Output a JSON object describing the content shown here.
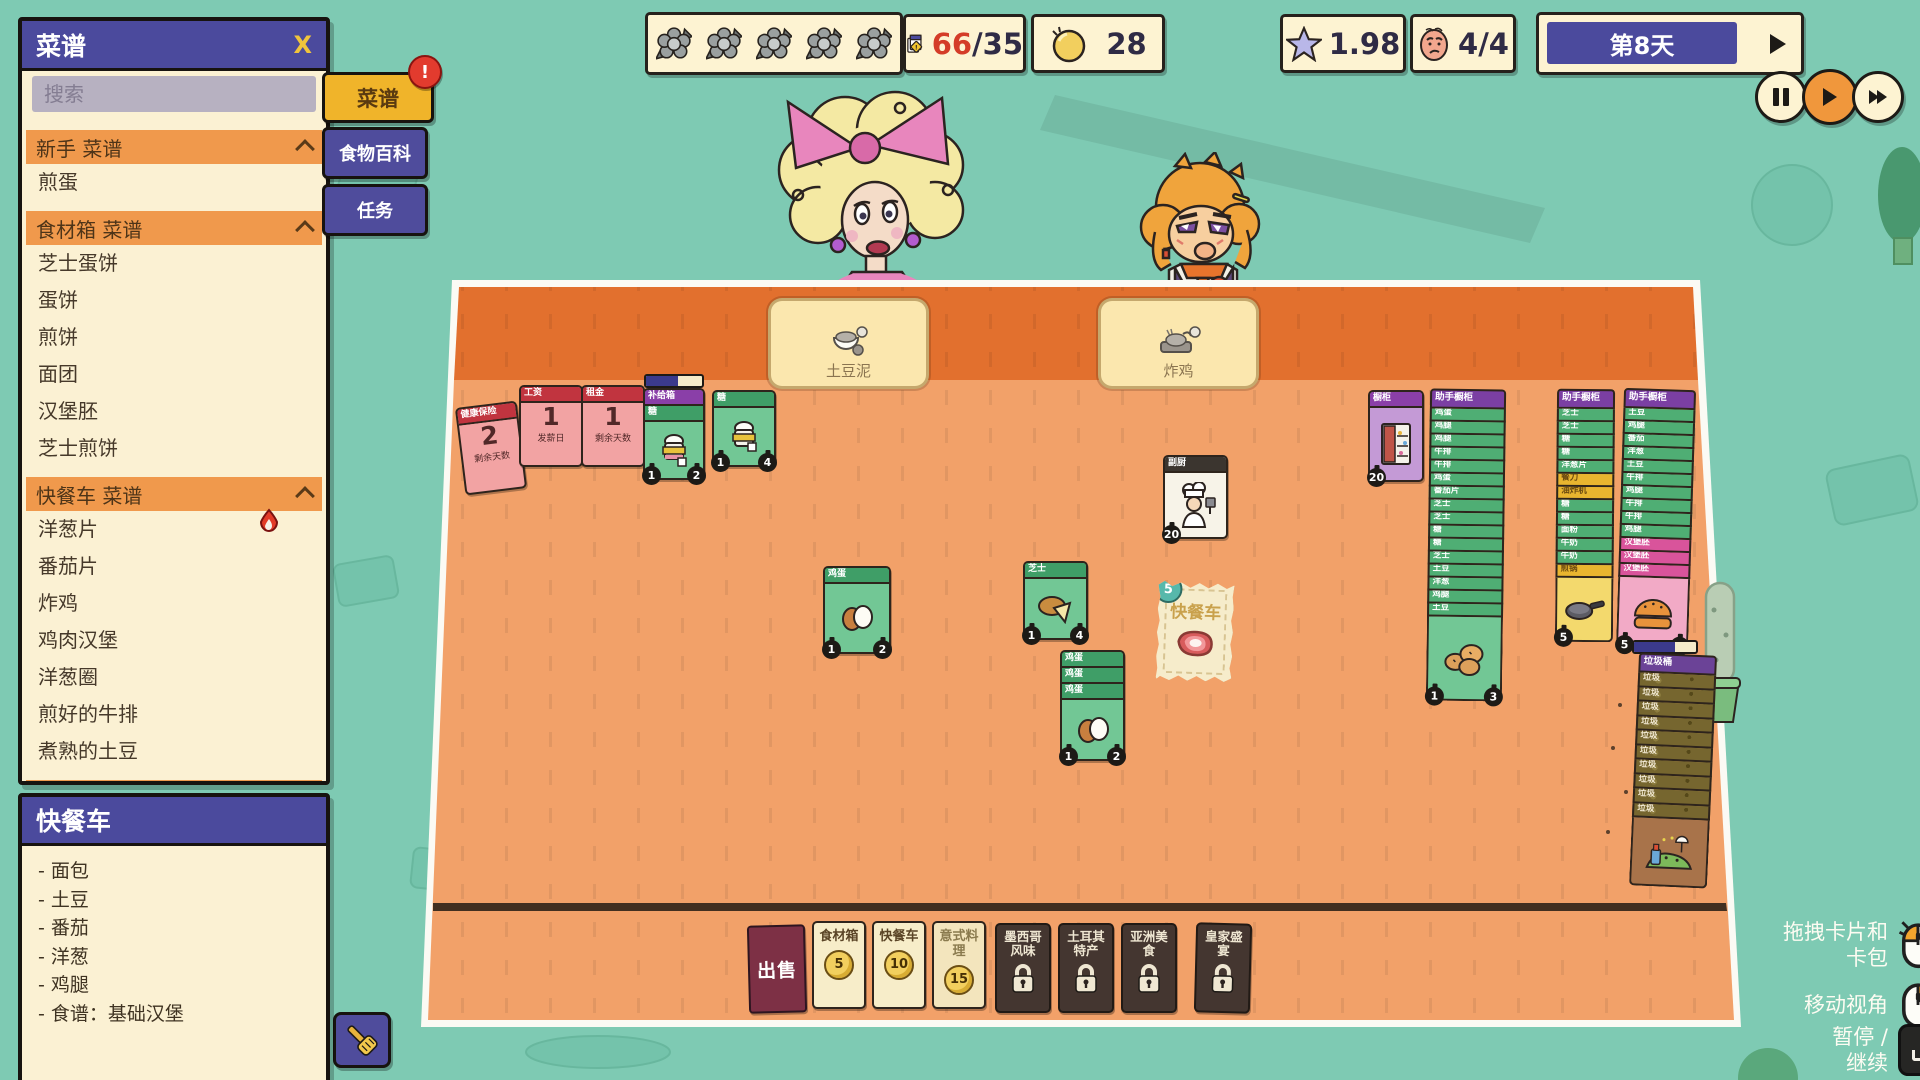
{
  "colors": {
    "background_teal": "#7ecab3",
    "board_top_orange": "#e2702e",
    "board_main_orange": "#f2a169",
    "panel_purple": "#4b4a9d",
    "section_orange": "#f0994c",
    "button_gold": "#f0b42a",
    "card_green": "#4fae74",
    "card_pink": "#f2a3a3",
    "locked_brown": "#443630",
    "sell_maroon": "#7d3045",
    "coin_yellow": "#f2cf5e",
    "alert_red": "#e23b2e"
  },
  "topbar": {
    "flowers": [
      "",
      "",
      "",
      "",
      ""
    ],
    "orders_current": "66",
    "orders_max": "/35",
    "coins": "28",
    "stars": "1.98",
    "mood": "4/4",
    "day_label": "第8天"
  },
  "side_buttons": {
    "recipes": "菜谱",
    "recipes_badge": "!",
    "encyclopedia": "食物百科",
    "tasks": "任务"
  },
  "recipes_panel": {
    "title": "菜谱",
    "close_label": "X",
    "search_placeholder": "搜索",
    "list": [
      {
        "kind": "header",
        "label": "新手 菜谱"
      },
      {
        "kind": "item",
        "label": "煎蛋"
      },
      {
        "kind": "header",
        "label": "食材箱 菜谱"
      },
      {
        "kind": "item",
        "label": "芝士蛋饼"
      },
      {
        "kind": "item",
        "label": "蛋饼"
      },
      {
        "kind": "item",
        "label": "煎饼"
      },
      {
        "kind": "item",
        "label": "面团"
      },
      {
        "kind": "item",
        "label": "汉堡胚"
      },
      {
        "kind": "item",
        "label": "芝士煎饼"
      },
      {
        "kind": "header",
        "label": "快餐车 菜谱"
      },
      {
        "kind": "item",
        "label": "洋葱片"
      },
      {
        "kind": "item",
        "label": "番茄片"
      },
      {
        "kind": "item",
        "label": "炸鸡"
      },
      {
        "kind": "item",
        "label": "鸡肉汉堡"
      },
      {
        "kind": "item",
        "label": "洋葱圈"
      },
      {
        "kind": "item",
        "label": "煎好的牛排"
      },
      {
        "kind": "item",
        "label": "煮熟的土豆"
      },
      {
        "kind": "header",
        "label": "意式料理 菜谱"
      }
    ]
  },
  "foodtruck_panel": {
    "title": "快餐车",
    "items": [
      "- 面包",
      "- 土豆",
      "- 番茄",
      "- 洋葱",
      "- 鸡腿",
      "- 食谱：基础汉堡"
    ]
  },
  "board": {
    "order_slots": [
      {
        "label": "土豆泥"
      },
      {
        "label": "炸鸡"
      }
    ],
    "cards": {
      "insurance": {
        "title": "健康保险",
        "value": "2",
        "caption": "剩余天数"
      },
      "wage": {
        "title": "工资",
        "value": "1",
        "caption": "发薪日"
      },
      "rent": {
        "title": "租金",
        "value": "1",
        "caption": "剩余天数"
      },
      "supply_box": {
        "title": "补给箱",
        "sub": "糖",
        "badge_left": "1",
        "badge_right": "2"
      },
      "sugar": {
        "title": "糖",
        "badge_left": "1",
        "badge_right": "4"
      },
      "eggs": {
        "title": "鸡蛋",
        "badge_left": "1",
        "badge_right": "2"
      },
      "cheese": {
        "title": "芝士",
        "badge_left": "1",
        "badge_right": "4"
      },
      "egg_stack": {
        "titles": [
          "鸡蛋",
          "鸡蛋",
          "鸡蛋"
        ],
        "badge_left": "1",
        "badge_right": "2"
      },
      "sous_chef": {
        "title": "副厨",
        "badge": "20"
      },
      "cabinet": {
        "title": "橱柜",
        "badge": "20"
      },
      "truck_pack": {
        "title": "快餐车",
        "badge": "5"
      }
    },
    "stacks": {
      "helper1": {
        "title": "助手橱柜",
        "rows": [
          {
            "label": "鸡蛋",
            "type": "g"
          },
          {
            "label": "鸡腿",
            "type": "g"
          },
          {
            "label": "鸡腿",
            "type": "g"
          },
          {
            "label": "牛排",
            "type": "g"
          },
          {
            "label": "牛排",
            "type": "g"
          },
          {
            "label": "鸡蛋",
            "type": "g"
          },
          {
            "label": "番茄片",
            "type": "g"
          },
          {
            "label": "芝士",
            "type": "g"
          },
          {
            "label": "芝士",
            "type": "g"
          },
          {
            "label": "糖",
            "type": "g"
          },
          {
            "label": "糖",
            "type": "g"
          },
          {
            "label": "芝士",
            "type": "g"
          },
          {
            "label": "土豆",
            "type": "g"
          },
          {
            "label": "洋葱",
            "type": "g"
          },
          {
            "label": "鸡腿",
            "type": "g"
          },
          {
            "label": "土豆",
            "type": "g"
          }
        ],
        "badge_left": "1",
        "badge_right": "3"
      },
      "helper2": {
        "title": "助手橱柜",
        "rows": [
          {
            "label": "芝士",
            "type": "g"
          },
          {
            "label": "芝士",
            "type": "g"
          },
          {
            "label": "糖",
            "type": "g"
          },
          {
            "label": "糖",
            "type": "g"
          },
          {
            "label": "洋葱片",
            "type": "g"
          },
          {
            "label": "餐刀",
            "type": "y"
          },
          {
            "label": "油炸机",
            "type": "y"
          },
          {
            "label": "糖",
            "type": "g"
          },
          {
            "label": "糖",
            "type": "g"
          },
          {
            "label": "面粉",
            "type": "g"
          },
          {
            "label": "牛奶",
            "type": "g"
          },
          {
            "label": "牛奶",
            "type": "g"
          },
          {
            "label": "煎锅",
            "type": "y"
          }
        ],
        "badge_left": "5"
      },
      "helper3": {
        "title": "助手橱柜",
        "rows": [
          {
            "label": "土豆",
            "type": "g"
          },
          {
            "label": "鸡腿",
            "type": "g"
          },
          {
            "label": "番茄",
            "type": "g"
          },
          {
            "label": "洋葱",
            "type": "g"
          },
          {
            "label": "土豆",
            "type": "g"
          },
          {
            "label": "牛排",
            "type": "g"
          },
          {
            "label": "鸡腿",
            "type": "g"
          },
          {
            "label": "牛排",
            "type": "g"
          },
          {
            "label": "牛排",
            "type": "g"
          },
          {
            "label": "鸡腿",
            "type": "g"
          },
          {
            "label": "汉堡胚",
            "type": "p"
          },
          {
            "label": "汉堡胚",
            "type": "p"
          },
          {
            "label": "汉堡胚",
            "type": "p"
          }
        ],
        "badge_left": "5",
        "badge_right": "4"
      },
      "trash": {
        "title": "垃圾桶",
        "rows": [
          {
            "label": "垃圾",
            "type": "t"
          },
          {
            "label": "垃圾",
            "type": "t"
          },
          {
            "label": "垃圾",
            "type": "t"
          },
          {
            "label": "垃圾",
            "type": "t"
          },
          {
            "label": "垃圾",
            "type": "t"
          },
          {
            "label": "垃圾",
            "type": "t"
          },
          {
            "label": "垃圾",
            "type": "t"
          },
          {
            "label": "垃圾",
            "type": "t"
          },
          {
            "label": "垃圾",
            "type": "t"
          },
          {
            "label": "垃圾",
            "type": "t"
          }
        ]
      }
    },
    "shop": {
      "sell_label": "出售",
      "packs": [
        {
          "label": "食材箱",
          "price": "5"
        },
        {
          "label": "快餐车",
          "price": "10"
        },
        {
          "label": "意式料理",
          "price": "15"
        }
      ],
      "locked_packs": [
        "墨西哥风味",
        "土耳其特产",
        "亚洲美食",
        "皇家盛宴"
      ]
    }
  },
  "hints": [
    {
      "line1": "拖拽卡片和",
      "line2": "卡包"
    },
    {
      "line1": "移动视角",
      "line2": ""
    },
    {
      "line1": "暂停 /",
      "line2": "继续"
    }
  ]
}
